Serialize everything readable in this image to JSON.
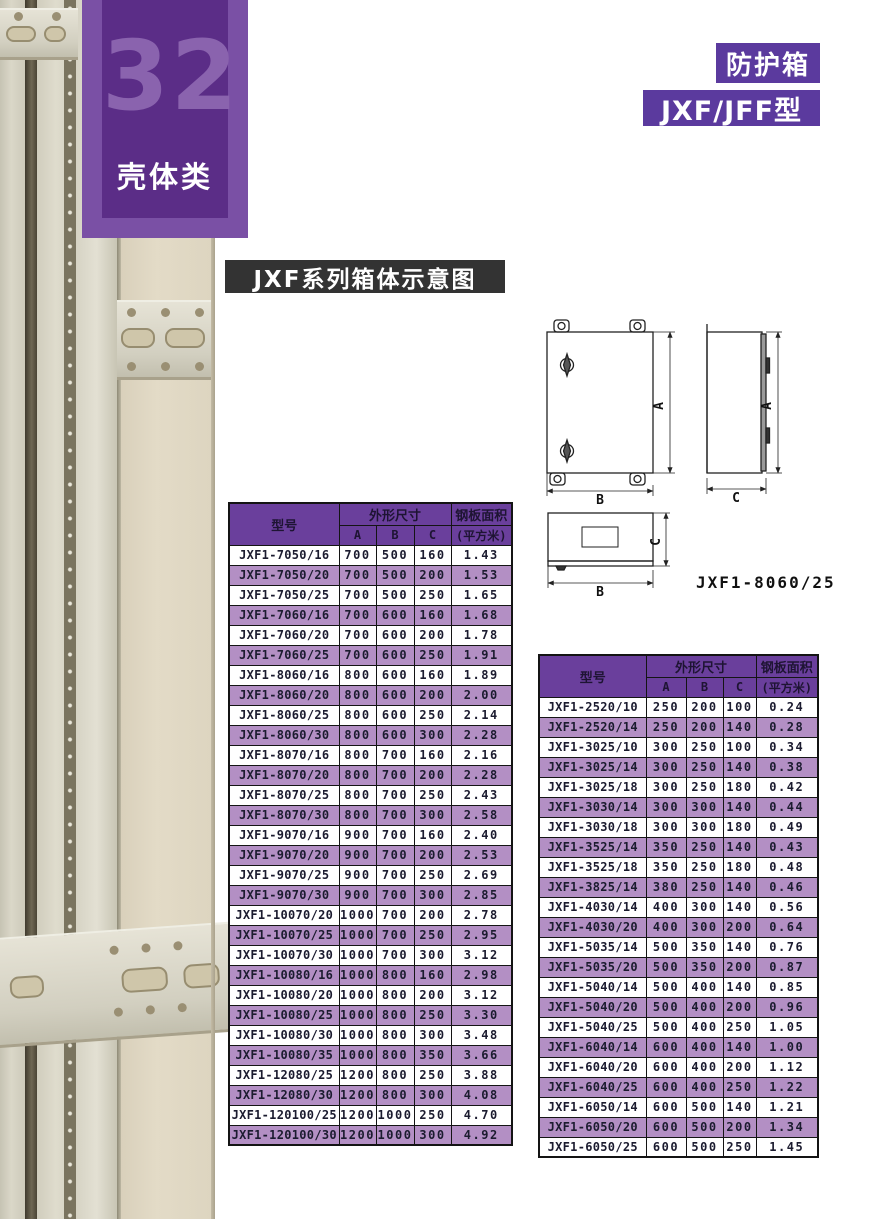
{
  "badge": {
    "number": "32",
    "category": "壳体类"
  },
  "header": {
    "product": "防护箱",
    "model": "JXF/JFF型"
  },
  "section_title": "JXF系列箱体示意图",
  "diagram": {
    "dim_a": "A",
    "dim_b": "B",
    "dim_c": "C",
    "caption": "JXF1-8060/25"
  },
  "tables": {
    "headers": {
      "model": "型号",
      "dimensions": "外形尺寸",
      "dim_a": "A",
      "dim_b": "B",
      "dim_c": "C",
      "area_line1": "钢板面积",
      "area_line2": "(平方米)"
    },
    "left_rows": [
      [
        "JXF1-7050/16",
        "700",
        "500",
        "160",
        "1.43"
      ],
      [
        "JXF1-7050/20",
        "700",
        "500",
        "200",
        "1.53"
      ],
      [
        "JXF1-7050/25",
        "700",
        "500",
        "250",
        "1.65"
      ],
      [
        "JXF1-7060/16",
        "700",
        "600",
        "160",
        "1.68"
      ],
      [
        "JXF1-7060/20",
        "700",
        "600",
        "200",
        "1.78"
      ],
      [
        "JXF1-7060/25",
        "700",
        "600",
        "250",
        "1.91"
      ],
      [
        "JXF1-8060/16",
        "800",
        "600",
        "160",
        "1.89"
      ],
      [
        "JXF1-8060/20",
        "800",
        "600",
        "200",
        "2.00"
      ],
      [
        "JXF1-8060/25",
        "800",
        "600",
        "250",
        "2.14"
      ],
      [
        "JXF1-8060/30",
        "800",
        "600",
        "300",
        "2.28"
      ],
      [
        "JXF1-8070/16",
        "800",
        "700",
        "160",
        "2.16"
      ],
      [
        "JXF1-8070/20",
        "800",
        "700",
        "200",
        "2.28"
      ],
      [
        "JXF1-8070/25",
        "800",
        "700",
        "250",
        "2.43"
      ],
      [
        "JXF1-8070/30",
        "800",
        "700",
        "300",
        "2.58"
      ],
      [
        "JXF1-9070/16",
        "900",
        "700",
        "160",
        "2.40"
      ],
      [
        "JXF1-9070/20",
        "900",
        "700",
        "200",
        "2.53"
      ],
      [
        "JXF1-9070/25",
        "900",
        "700",
        "250",
        "2.69"
      ],
      [
        "JXF1-9070/30",
        "900",
        "700",
        "300",
        "2.85"
      ],
      [
        "JXF1-10070/20",
        "1000",
        "700",
        "200",
        "2.78"
      ],
      [
        "JXF1-10070/25",
        "1000",
        "700",
        "250",
        "2.95"
      ],
      [
        "JXF1-10070/30",
        "1000",
        "700",
        "300",
        "3.12"
      ],
      [
        "JXF1-10080/16",
        "1000",
        "800",
        "160",
        "2.98"
      ],
      [
        "JXF1-10080/20",
        "1000",
        "800",
        "200",
        "3.12"
      ],
      [
        "JXF1-10080/25",
        "1000",
        "800",
        "250",
        "3.30"
      ],
      [
        "JXF1-10080/30",
        "1000",
        "800",
        "300",
        "3.48"
      ],
      [
        "JXF1-10080/35",
        "1000",
        "800",
        "350",
        "3.66"
      ],
      [
        "JXF1-12080/25",
        "1200",
        "800",
        "250",
        "3.88"
      ],
      [
        "JXF1-12080/30",
        "1200",
        "800",
        "300",
        "4.08"
      ],
      [
        "JXF1-120100/25",
        "1200",
        "1000",
        "250",
        "4.70"
      ],
      [
        "JXF1-120100/30",
        "1200",
        "1000",
        "300",
        "4.92"
      ]
    ],
    "right_rows": [
      [
        "JXF1-2520/10",
        "250",
        "200",
        "100",
        "0.24"
      ],
      [
        "JXF1-2520/14",
        "250",
        "200",
        "140",
        "0.28"
      ],
      [
        "JXF1-3025/10",
        "300",
        "250",
        "100",
        "0.34"
      ],
      [
        "JXF1-3025/14",
        "300",
        "250",
        "140",
        "0.38"
      ],
      [
        "JXF1-3025/18",
        "300",
        "250",
        "180",
        "0.42"
      ],
      [
        "JXF1-3030/14",
        "300",
        "300",
        "140",
        "0.44"
      ],
      [
        "JXF1-3030/18",
        "300",
        "300",
        "180",
        "0.49"
      ],
      [
        "JXF1-3525/14",
        "350",
        "250",
        "140",
        "0.43"
      ],
      [
        "JXF1-3525/18",
        "350",
        "250",
        "180",
        "0.48"
      ],
      [
        "JXF1-3825/14",
        "380",
        "250",
        "140",
        "0.46"
      ],
      [
        "JXF1-4030/14",
        "400",
        "300",
        "140",
        "0.56"
      ],
      [
        "JXF1-4030/20",
        "400",
        "300",
        "200",
        "0.64"
      ],
      [
        "JXF1-5035/14",
        "500",
        "350",
        "140",
        "0.76"
      ],
      [
        "JXF1-5035/20",
        "500",
        "350",
        "200",
        "0.87"
      ],
      [
        "JXF1-5040/14",
        "500",
        "400",
        "140",
        "0.85"
      ],
      [
        "JXF1-5040/20",
        "500",
        "400",
        "200",
        "0.96"
      ],
      [
        "JXF1-5040/25",
        "500",
        "400",
        "250",
        "1.05"
      ],
      [
        "JXF1-6040/14",
        "600",
        "400",
        "140",
        "1.00"
      ],
      [
        "JXF1-6040/20",
        "600",
        "400",
        "200",
        "1.12"
      ],
      [
        "JXF1-6040/25",
        "600",
        "400",
        "250",
        "1.22"
      ],
      [
        "JXF1-6050/14",
        "600",
        "500",
        "140",
        "1.21"
      ],
      [
        "JXF1-6050/20",
        "600",
        "500",
        "200",
        "1.34"
      ],
      [
        "JXF1-6050/25",
        "600",
        "500",
        "250",
        "1.45"
      ]
    ]
  },
  "colors": {
    "purple_badge": "#7a50a5",
    "purple_badge_inner": "#5b2d87",
    "purple_badge_number": "#8a63ae",
    "purple_tag": "#5b3a9e",
    "table_header_bg": "#6a3f9c",
    "table_row_alt": "#b38fc4",
    "title_bar_bg": "#333333",
    "photo_beige": "#ded6c3"
  }
}
